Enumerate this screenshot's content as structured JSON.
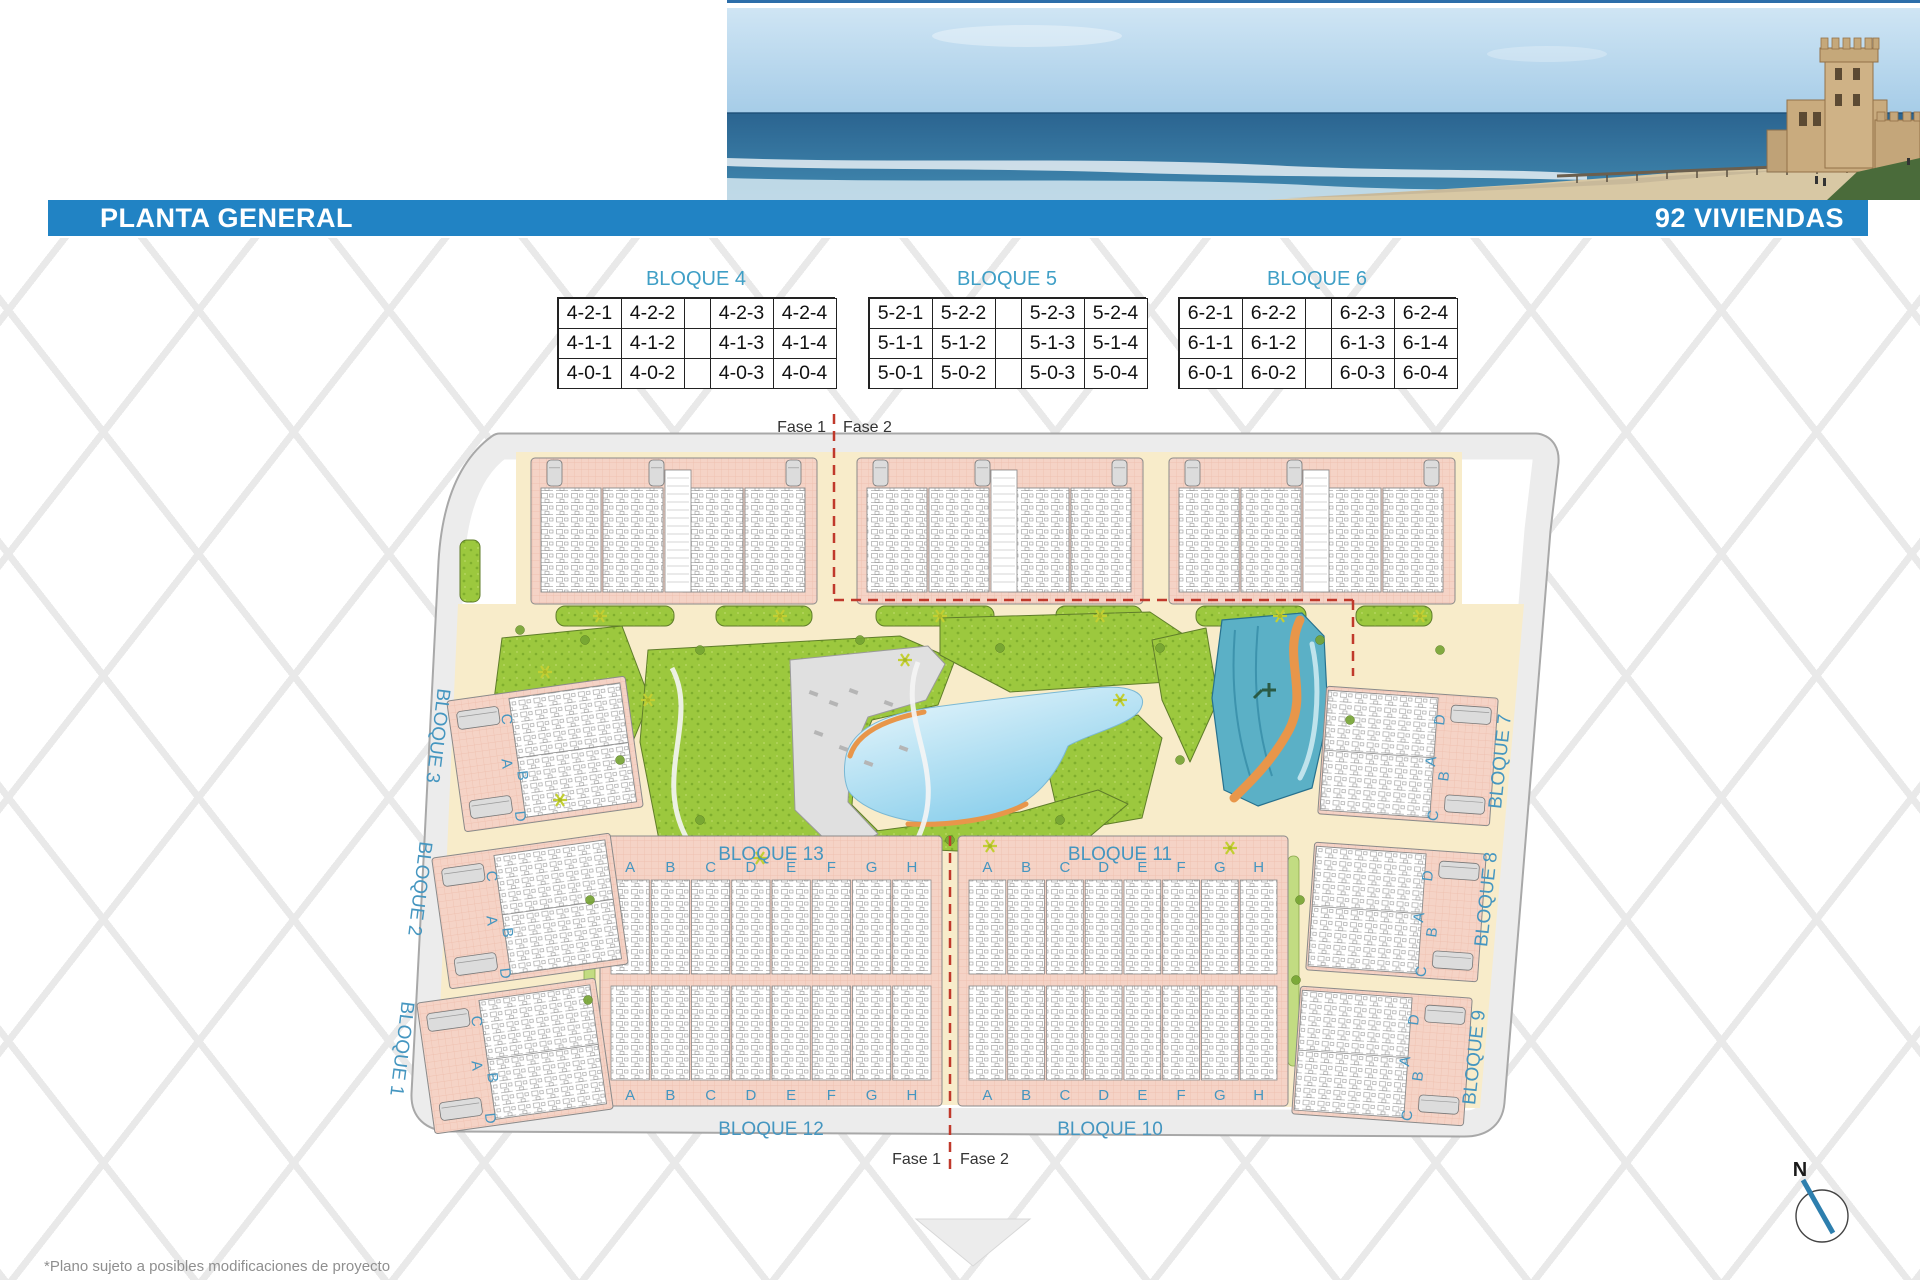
{
  "header": {
    "title": "PLANTA GENERAL",
    "units_badge": "92 VIVIENDAS"
  },
  "unit_tables": [
    {
      "title": "BLOQUE 4",
      "rows": [
        [
          "4-2-1",
          "4-2-2",
          "",
          "4-2-3",
          "4-2-4"
        ],
        [
          "4-1-1",
          "4-1-2",
          "",
          "4-1-3",
          "4-1-4"
        ],
        [
          "4-0-1",
          "4-0-2",
          "",
          "4-0-3",
          "4-0-4"
        ]
      ]
    },
    {
      "title": "BLOQUE 5",
      "rows": [
        [
          "5-2-1",
          "5-2-2",
          "",
          "5-2-3",
          "5-2-4"
        ],
        [
          "5-1-1",
          "5-1-2",
          "",
          "5-1-3",
          "5-1-4"
        ],
        [
          "5-0-1",
          "5-0-2",
          "",
          "5-0-3",
          "5-0-4"
        ]
      ]
    },
    {
      "title": "BLOQUE 6",
      "rows": [
        [
          "6-2-1",
          "6-2-2",
          "",
          "6-2-3",
          "6-2-4"
        ],
        [
          "6-1-1",
          "6-1-2",
          "",
          "6-1-3",
          "6-1-4"
        ],
        [
          "6-0-1",
          "6-0-2",
          "",
          "6-0-3",
          "6-0-4"
        ]
      ]
    }
  ],
  "plan": {
    "fase1": "Fase 1",
    "fase2": "Fase 2",
    "block_labels": {
      "b1": "BLOQUE 1",
      "b2": "BLOQUE 2",
      "b3": "BLOQUE 3",
      "b7": "BLOQUE 7",
      "b8": "BLOQUE 8",
      "b9": "BLOQUE 9",
      "b10": "BLOQUE 10",
      "b11": "BLOQUE 11",
      "b12": "BLOQUE 12",
      "b13": "BLOQUE 13"
    },
    "unit_letters": [
      "A",
      "B",
      "C",
      "D",
      "E",
      "F",
      "G",
      "H"
    ],
    "side_letters_left": [
      "C",
      "A",
      "B",
      "D"
    ],
    "side_letters_right": [
      "D",
      "A",
      "B",
      "C"
    ],
    "compass": "N"
  },
  "footer": {
    "disclaimer": "*Plano sujeto a posibles modificaciones de proyecto"
  },
  "colors": {
    "bar_blue": "#2183c4",
    "label_blue": "#4596c0",
    "table_title_blue": "#3f9fc6",
    "building_pink": "#f5d3c6",
    "green": "#9cc83e",
    "lagoon_blue": "#86cdeb",
    "river_teal": "#5bb0c6",
    "sand_orange": "#e8964a",
    "road_gray": "#ececec",
    "phase_red": "#c0392b"
  }
}
